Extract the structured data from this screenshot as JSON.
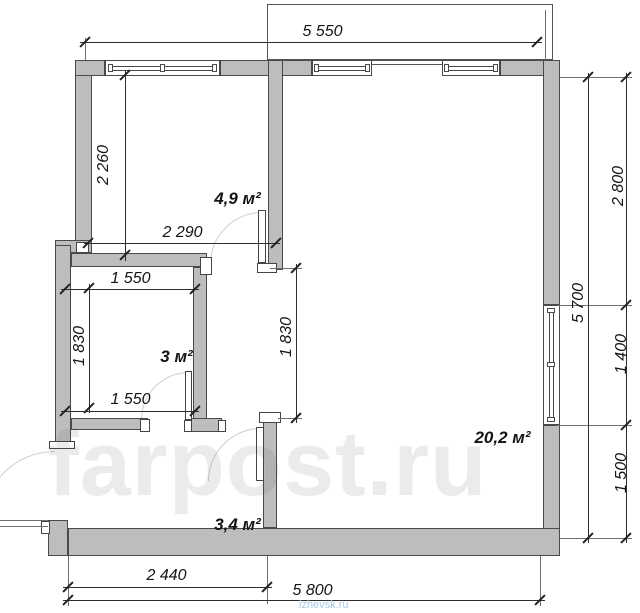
{
  "plan": {
    "title": "apartment floor plan",
    "rooms": [
      {
        "id": "kitchen",
        "area_label": "4,9 м²"
      },
      {
        "id": "storage",
        "area_label": "3 м²"
      },
      {
        "id": "living-room",
        "area_label": "20,2 м²"
      },
      {
        "id": "hallway",
        "area_label": "3,4 м²"
      }
    ],
    "dimensions": {
      "top_width": "5 550",
      "kitchen_height": "2 260",
      "kitchen_width": "2 290",
      "storage_width_top": "1 550",
      "storage_height": "1 830",
      "storage_width_bottom": "1 550",
      "living_opening_height": "1 830",
      "right_total_height": "5 700",
      "right_upper_segment": "2 800",
      "right_window_segment": "1 400",
      "right_lower_segment": "1 500",
      "bottom_left_width": "2 440",
      "bottom_total_width": "5 800"
    },
    "watermark_large": "farpost.ru",
    "watermark_small": "izhevsk.ru",
    "colors": {
      "wall_fill": "#bdbdbd",
      "wall_stroke": "#4a4a4a",
      "dimension_line": "#2e2e2e",
      "watermark_blue": "#a9c9e2"
    }
  }
}
